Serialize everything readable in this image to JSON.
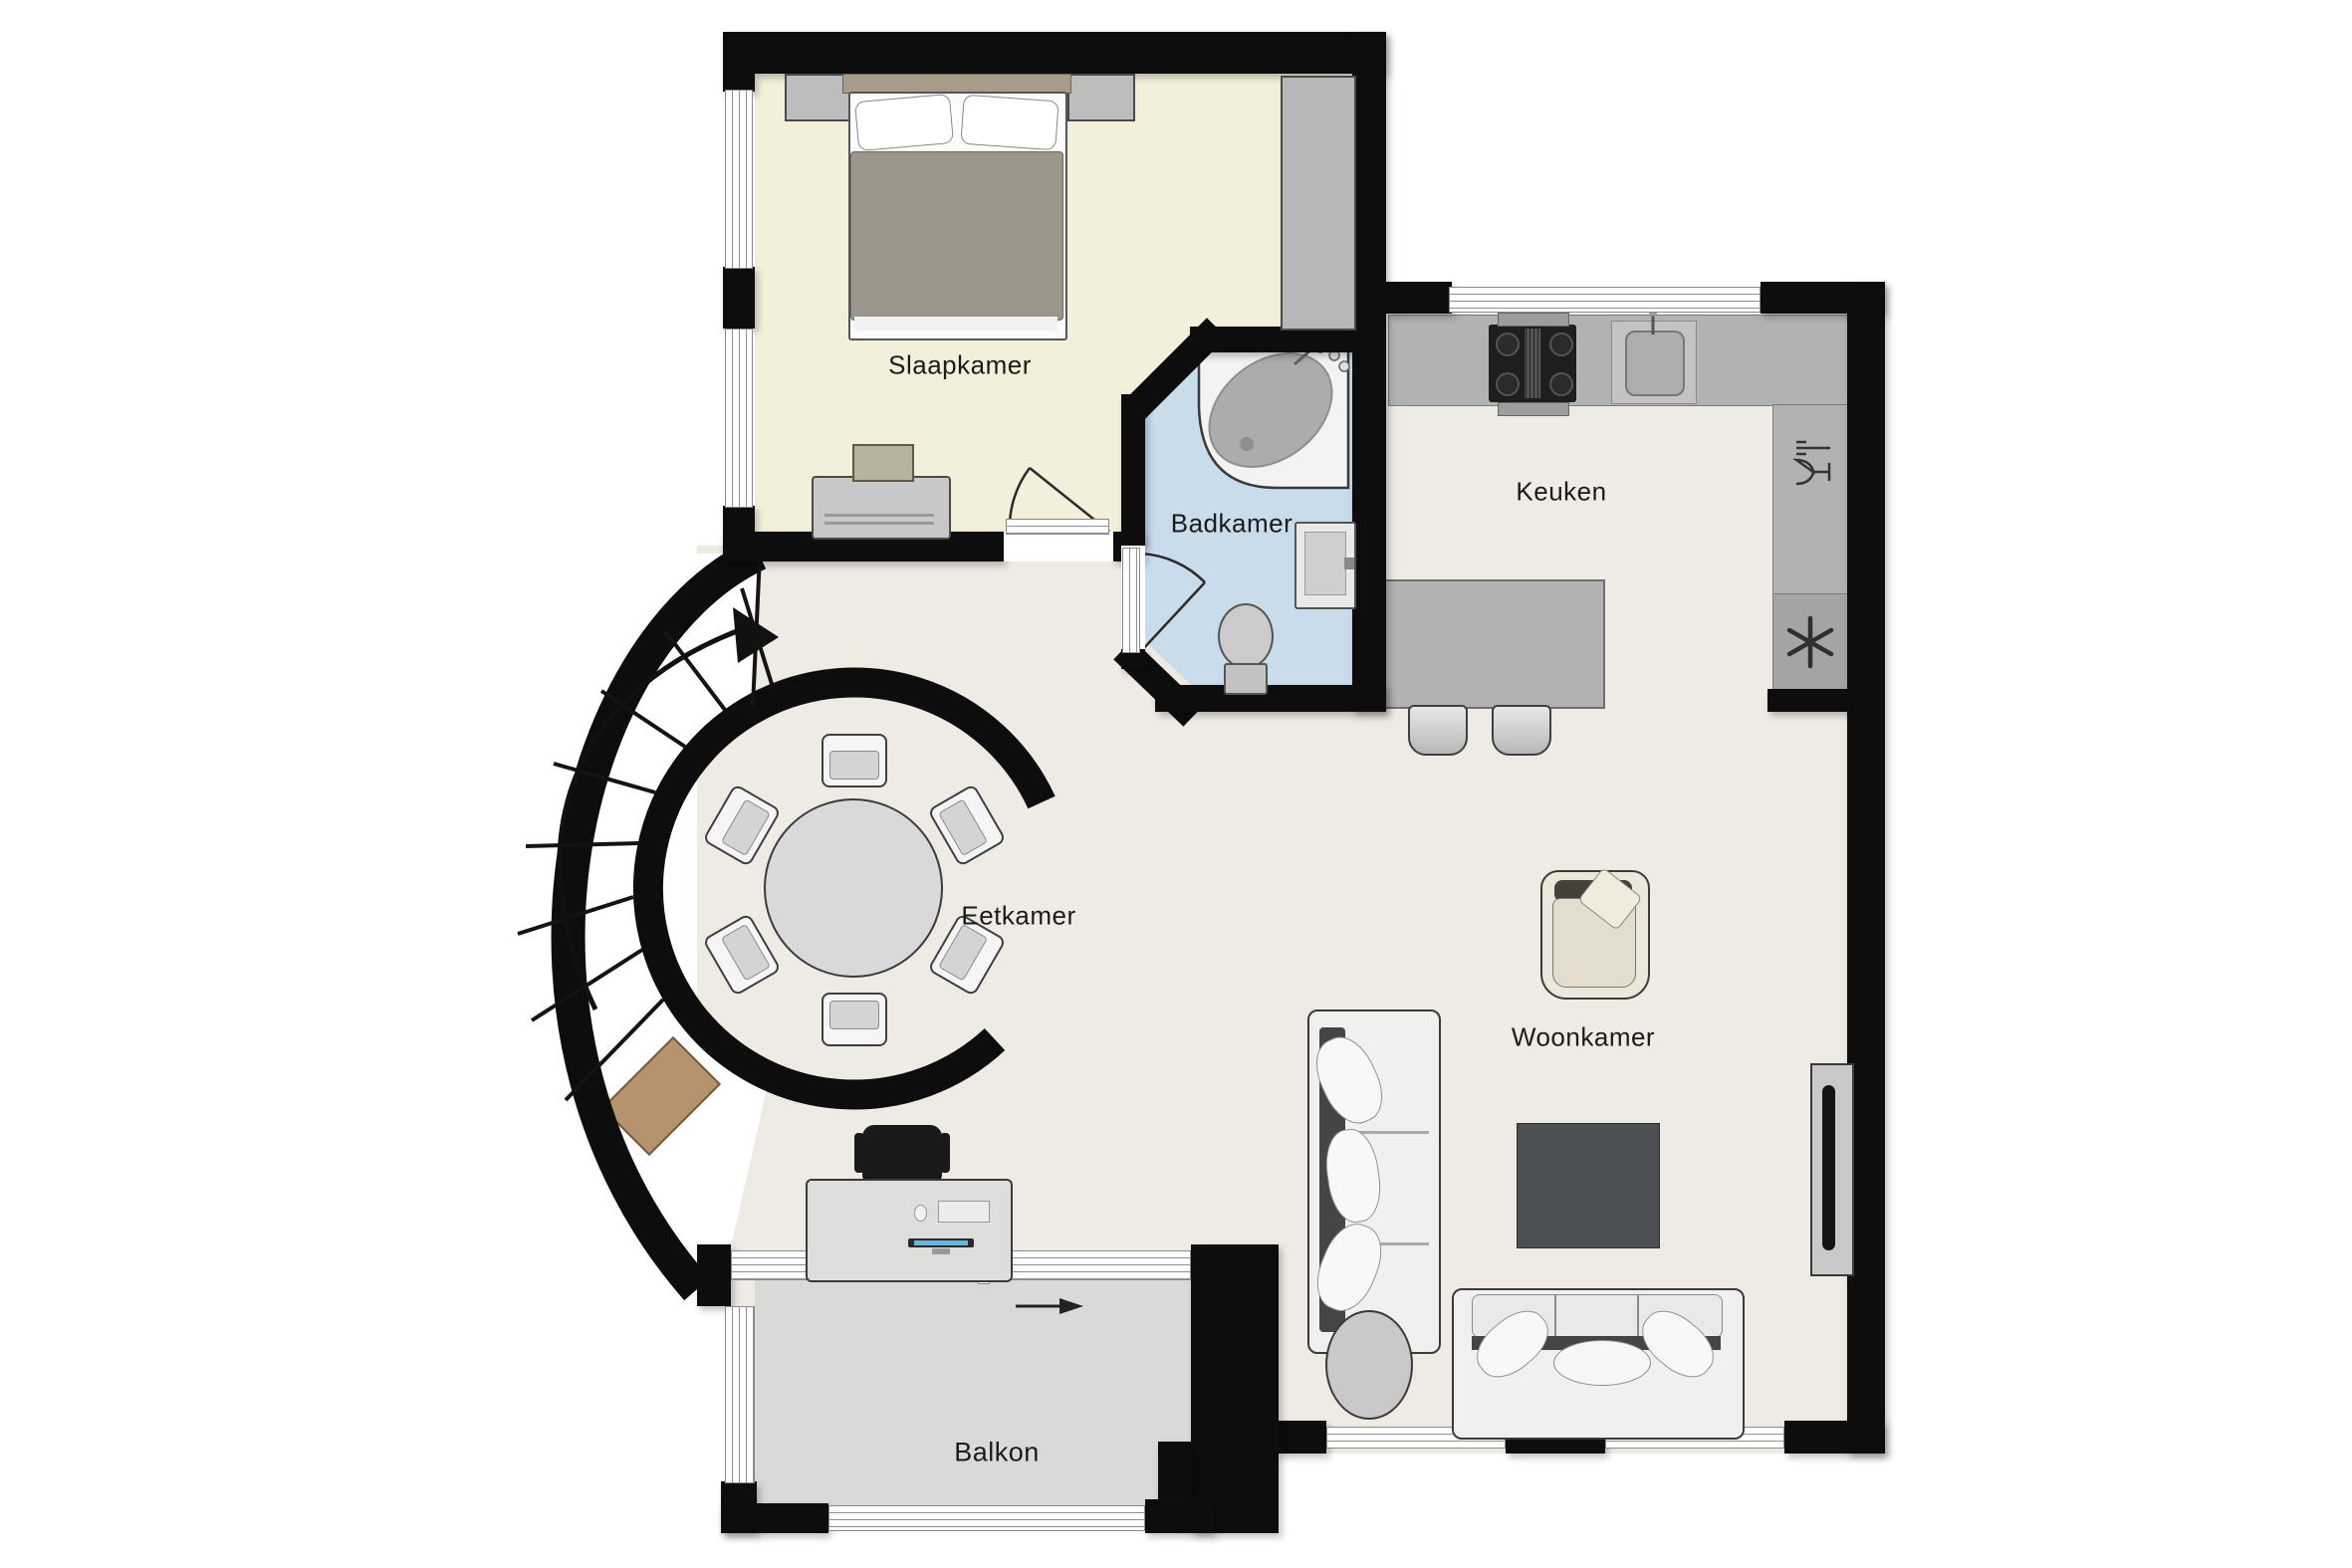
{
  "title": "Appartement plattegrond",
  "rooms": {
    "slaapkamer": {
      "label": "Slaapkamer"
    },
    "badkamer": {
      "label": "Badkamer"
    },
    "keuken": {
      "label": "Keuken"
    },
    "eetkamer": {
      "label": "Eetkamer"
    },
    "woonkamer": {
      "label": "Woonkamer"
    },
    "balkon": {
      "label": "Balkon"
    }
  },
  "colors": {
    "wall": "#0d0d0d",
    "bedroom_floor": "#f2efda",
    "bathroom_floor": "#c8dcec",
    "main_floor": "#edebe4",
    "balcony_floor": "#d9d9d7",
    "counter": "#b2b2b2",
    "rug": "#4c5053",
    "wood_step": "#b5946d",
    "monitor_screen": "#6db4dc"
  },
  "furniture": {
    "bedroom": [
      "double-bed",
      "pillows",
      "nightstand-left",
      "nightstand-right",
      "wardrobe",
      "dresser"
    ],
    "bathroom": [
      "corner-bathtub",
      "toilet",
      "washbasin",
      "bath-taps"
    ],
    "kitchen": [
      "stove-4-burners",
      "kitchen-sink",
      "dishwasher",
      "freezer",
      "island-bar",
      "bar-stool",
      "bar-stool"
    ],
    "dining": [
      "round-dining-table",
      "dining-chair-x6"
    ],
    "living": [
      "sofa-3-seat",
      "sofa-2-seat",
      "armchair",
      "rug",
      "tv-on-wall-cabinet",
      "round-side-table"
    ],
    "workspot": [
      "desk",
      "office-chair",
      "monitor",
      "keyboard",
      "mouse"
    ],
    "circulation": [
      "spiral-staircase",
      "wooden-step"
    ],
    "outdoor": [
      "balcony-railing"
    ]
  },
  "icons": {
    "freezer-icon": "snowflake-asterisk",
    "dishwasher-icon": "wine-glass-and-fork",
    "stair-direction-arrow": "curved-arrow",
    "sliding-door-arrow": "right-arrow",
    "door-swing": "quarter-arc"
  }
}
